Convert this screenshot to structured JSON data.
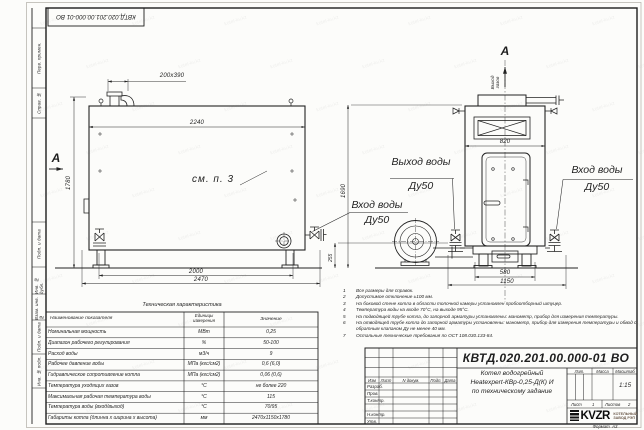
{
  "watermark": "kotel-kv.kz",
  "stamp": {
    "doc_number": "КВТД.020.201.00.000-01 ВО"
  },
  "margin": {
    "top_labels": [
      "Перв. примен.",
      "Справ. №"
    ],
    "bottom_labels": [
      "Подп. и дата",
      "Инв. № дубл.",
      "Взам. инв. №",
      "Подп. и дата",
      "Инв. № подл."
    ]
  },
  "drawing": {
    "section_mark": "А",
    "view_mark": "А",
    "gas_outlet_label": "Выход газов",
    "see_note_label": "см. п. 3",
    "callouts": {
      "outlet": {
        "title": "Выход воды",
        "size": "Ду50"
      },
      "inlet_front": {
        "title": "Вход воды",
        "size": "Ду50"
      },
      "inlet_side": {
        "title": "Вход воды",
        "size": "Ду50"
      }
    },
    "dimensions": {
      "chimney_opening": "200x390",
      "shell_width": "2240",
      "overall_height": "1780",
      "leg_span": "2000",
      "overall_length": "2470",
      "side_top_width": "820",
      "base_width": "580",
      "overall_width": "1150",
      "side_height": "1690",
      "nozzle_height": "255"
    }
  },
  "spec_table": {
    "title": "Техническая характеристика",
    "headers": [
      "Наименование показателя",
      "Единицы измерения",
      "Значение"
    ],
    "rows": [
      [
        "Номинальная мощность",
        "МВт",
        "0,25"
      ],
      [
        "Диапазон рабочего регулирования",
        "%",
        "50-100"
      ],
      [
        "Расход воды",
        "м3/ч",
        "9"
      ],
      [
        "Рабочее давление воды",
        "МПа (кгс/см2)",
        "0,6 (6,0)"
      ],
      [
        "Гидравлическое сопротивление котла",
        "МПа (кгс/см2)",
        "0,06 (0,6)"
      ],
      [
        "Температура уходящих газов",
        "°С",
        "не более 220"
      ],
      [
        "Максимальная рабочая температура воды",
        "°С",
        "115"
      ],
      [
        "Температура воды (вход/выход)",
        "°С",
        "70/95"
      ],
      [
        "Габариты котла (длинна х ширина х высота)",
        "мм",
        "2470х1150х1780"
      ]
    ]
  },
  "notes": [
    "Все размеры для справок.",
    "Допустимое отклонение ±100 мм.",
    "На боковой стене котла в области топочной камеры установлен пробоотборный штуцер.",
    "Температура воды на входе 70°С, на выходе 95°С.",
    "На подводящей трубе котла, до запорной арматуры установлены: манометр, прибор для измерения температуры.",
    "На отводящей трубе котла до запорной арматуры установлены: манометр, прибор для измерения температуры и обвод с обратным клапаном Ду не менее 40 мм.",
    "Остальные технические требования по ОСТ 108.030.133-84."
  ],
  "titleblock": {
    "doc_number": "КВТД.020.201.00.000-01 ВО",
    "product_name_line1": "Котел водогрейный",
    "product_name_line2": "Heatexpert-КВр-0,25-Д(К) И",
    "product_name_line3": "по техническому задание",
    "col_izm": "Изм",
    "col_list": "Лист",
    "col_ndoc": "N докум.",
    "col_podp": "Подп.",
    "col_data": "Дата",
    "row_razrab": "Разраб.",
    "row_prov": "Пров.",
    "row_tkontr": "Т.контр.",
    "row_nkontr": "Н.контр.",
    "row_utv": "Утв.",
    "lit_label": "Лит.",
    "massa_label": "Масса",
    "masshtab_label": "Масштаб",
    "scale_value": "1:15",
    "sheet_label": "Лист",
    "sheet_value": "1",
    "sheets_label": "Листов",
    "sheets_value": "2",
    "company_logo": "KVZR",
    "company_name_line1": "КОТЕЛЬНЫЙ",
    "company_name_line2": "ЗАВОД РЭП",
    "format_label": "Формат",
    "format_value": "А3"
  }
}
